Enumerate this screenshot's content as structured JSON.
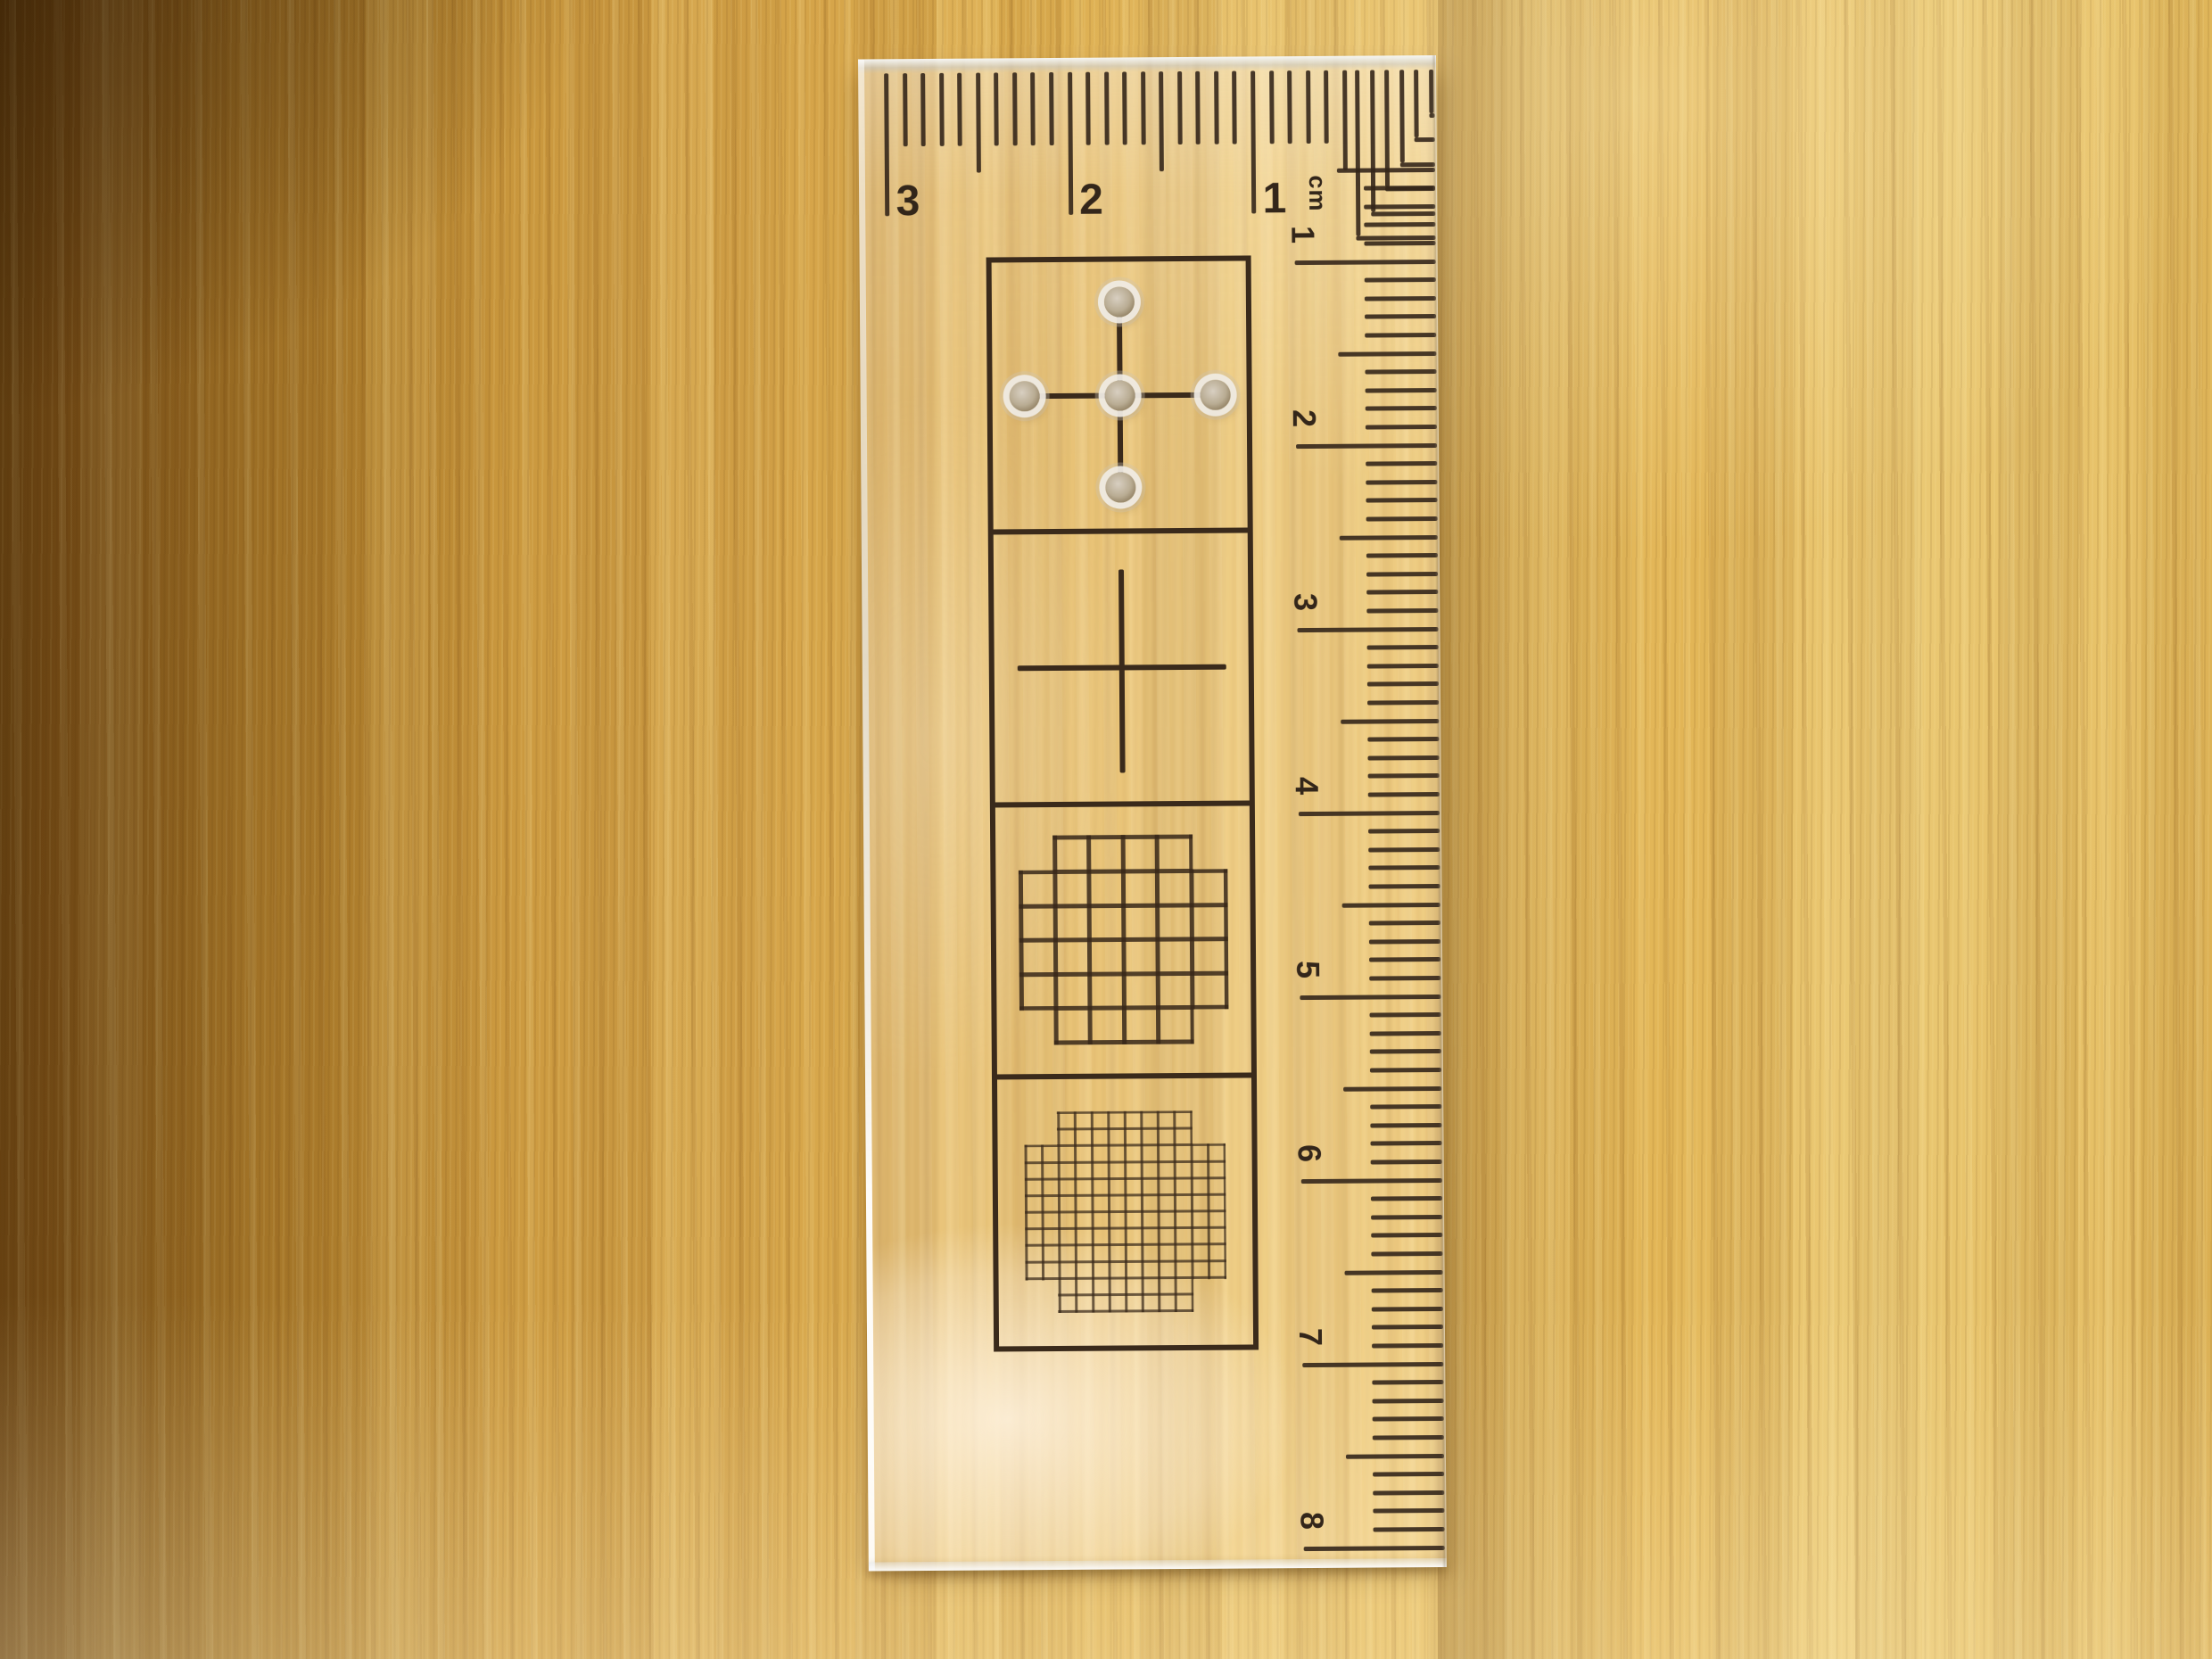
{
  "scene": {
    "subject": "Transparent acrylic calibration ruler lying vertically on a wooden desk",
    "lighting": "warm indoor light with shadow at upper left"
  },
  "wood": {
    "base_color": "#d5a449",
    "dark_color": "#6e4a15",
    "light_color": "#eac873"
  },
  "ruler": {
    "material": "clear acrylic",
    "ink_color": "#34261a",
    "unit": "cm",
    "horizontal_scale": {
      "ticks_per_cm": 10,
      "reads": "right-to-left from top-right corner",
      "marks": [
        {
          "label": "3",
          "cm": 3
        },
        {
          "label": "2",
          "cm": 2
        },
        {
          "label": "1",
          "cm": 1
        }
      ]
    },
    "vertical_scale": {
      "ticks_per_cm": 10,
      "reads": "top-to-bottom along right edge, digits rotated 90deg",
      "marks": [
        {
          "label": "1",
          "cm": 1
        },
        {
          "label": "2",
          "cm": 2
        },
        {
          "label": "3",
          "cm": 3
        },
        {
          "label": "4",
          "cm": 4
        },
        {
          "label": "5",
          "cm": 5
        },
        {
          "label": "6",
          "cm": 6
        },
        {
          "label": "7",
          "cm": 7
        },
        {
          "label": "8",
          "cm": 8
        }
      ]
    },
    "corner_brackets": {
      "count": 6,
      "style": "nested right angles at top-right corner"
    },
    "panels": [
      {
        "id": "cross-with-holes",
        "description": "crosshair with 5 drilled holes",
        "hole_count": 5
      },
      {
        "id": "crosshair",
        "description": "plain crosshair"
      },
      {
        "id": "coarse-grid-circle",
        "description": "6x6 grid clipped to circle",
        "cells": 6
      },
      {
        "id": "fine-grid-circle",
        "description": "12x12 grid clipped to circle",
        "cells": 12
      }
    ]
  }
}
